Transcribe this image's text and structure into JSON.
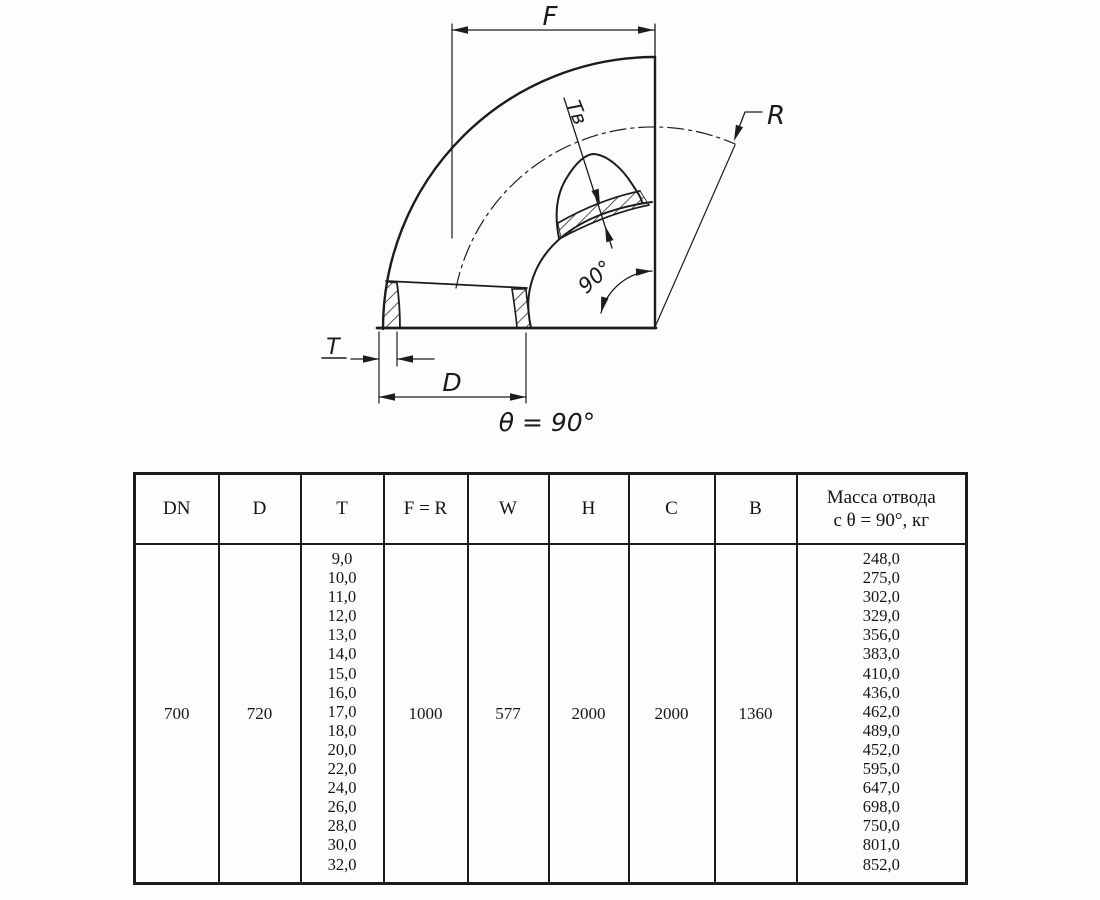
{
  "drawing": {
    "labels": {
      "f": "F",
      "r": "R",
      "t": "T",
      "d": "D",
      "t_inner": "Tв",
      "angle": "90°",
      "theta_note": "θ = 90°"
    }
  },
  "table": {
    "headers": [
      "DN",
      "D",
      "T",
      "F = R",
      "W",
      "H",
      "C",
      "B"
    ],
    "mass_header_line1": "Масса отвода",
    "mass_header_line2": "с θ =  90°, кг",
    "row": {
      "dn": "700",
      "d": "720",
      "f_r": "1000",
      "w": "577",
      "h": "2000",
      "c": "2000",
      "b": "1360"
    },
    "t_values": [
      "9,0",
      "10,0",
      "11,0",
      "12,0",
      "13,0",
      "14,0",
      "15,0",
      "16,0",
      "17,0",
      "18,0",
      "20,0",
      "22,0",
      "24,0",
      "26,0",
      "28,0",
      "30,0",
      "32,0"
    ],
    "mass_values": [
      "248,0",
      "275,0",
      "302,0",
      "329,0",
      "356,0",
      "383,0",
      "410,0",
      "436,0",
      "462,0",
      "489,0",
      "452,0",
      "595,0",
      "647,0",
      "698,0",
      "750,0",
      "801,0",
      "852,0"
    ]
  }
}
